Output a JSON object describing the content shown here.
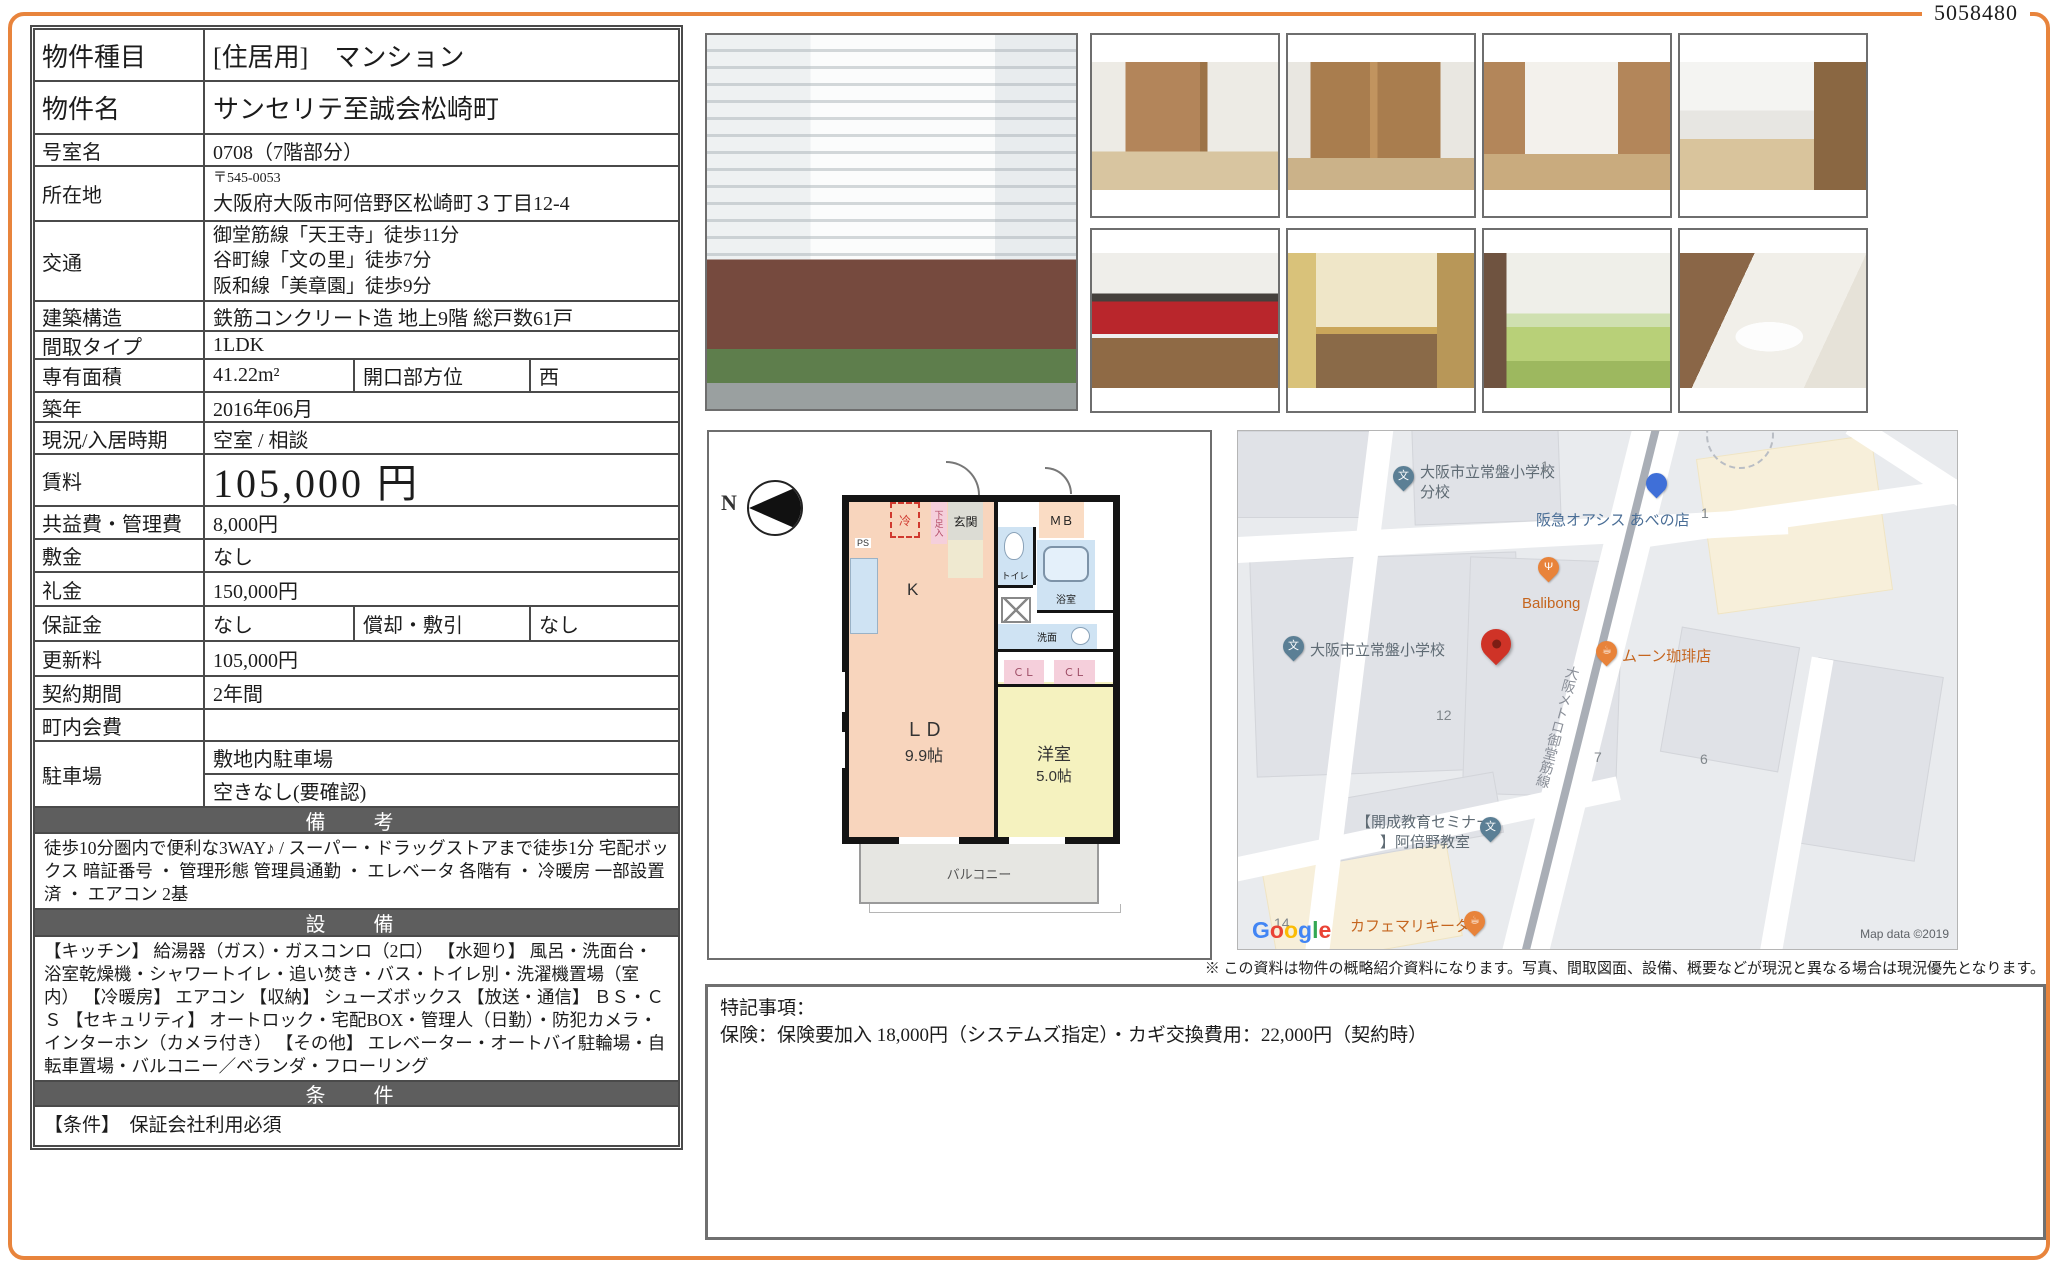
{
  "doc_number": "5058480",
  "colors": {
    "accent_orange": "#e8843c",
    "section_header_gray": "#5e5e5e",
    "marker_red": "#cf3327",
    "plan_ld": "#f8d5bd",
    "plan_west": "#f5f2bf",
    "plan_wet": "#cfe3f3",
    "plan_closet": "#f5cfdb"
  },
  "table": {
    "property_type": {
      "label": "物件種目",
      "value": "[住居用]　マンション"
    },
    "property_name": {
      "label": "物件名",
      "value": "サンセリテ至誠会松崎町"
    },
    "room_no": {
      "label": "号室名",
      "value": "0708（7階部分）"
    },
    "address": {
      "label": "所在地",
      "postal": "〒545-0053",
      "value": "大阪府大阪市阿倍野区松崎町３丁目12-4"
    },
    "transit": {
      "label": "交通",
      "lines": [
        "御堂筋線「天王寺」徒歩11分",
        "谷町線「文の里」徒歩7分",
        "阪和線「美章園」徒歩9分"
      ]
    },
    "structure": {
      "label": "建築構造",
      "value": "鉄筋コンクリート造 地上9階 総戸数61戸"
    },
    "layout_type": {
      "label": "間取タイプ",
      "value": "1LDK"
    },
    "area": {
      "label": "専有面積",
      "value": "41.22m²",
      "sub_label": "開口部方位",
      "sub_value": "西"
    },
    "built": {
      "label": "築年",
      "value": "2016年06月"
    },
    "status": {
      "label": "現況/入居時期",
      "value": "空室 / 相談"
    },
    "rent": {
      "label": "賃料",
      "value": "105,000 円"
    },
    "fees": {
      "label": "共益費・管理費",
      "value": "8,000円"
    },
    "deposit": {
      "label": "敷金",
      "value": "なし"
    },
    "key_money": {
      "label": "礼金",
      "value": "150,000円"
    },
    "guarantee": {
      "label": "保証金",
      "value": "なし",
      "sub_label": "償却・敷引",
      "sub_value": "なし"
    },
    "renewal_fee": {
      "label": "更新料",
      "value": "105,000円"
    },
    "contract_term": {
      "label": "契約期間",
      "value": "2年間"
    },
    "town_fee": {
      "label": "町内会費",
      "value": ""
    },
    "parking": {
      "label": "駐車場",
      "value1": "敷地内駐車場",
      "value2": "空きなし(要確認)"
    },
    "remarks": {
      "header": "備　考",
      "text": "徒歩10分圏内で便利な3WAY♪ /  スーパー・ドラッグストアまで徒歩1分 宅配ボックス 暗証番号 ・ 管理形態 管理員通勤 ・ エレベータ 各階有 ・ 冷暖房 一部設置済 ・ エアコン 2基"
    },
    "equipment": {
      "header": "設　備",
      "text": "【キッチン】 給湯器（ガス）・ガスコンロ（2口） 【水廻り】 風呂・洗面台・浴室乾燥機・シャワートイレ・追い焚き・バス・トイレ別・洗濯機置場（室内） 【冷暖房】 エアコン 【収納】 シューズボックス 【放送・通信】 ＢＳ・ＣＳ 【セキュリティ】 オートロック・宅配BOX・管理人（日勤）・防犯カメラ・インターホン（カメラ付き） 【その他】 エレベーター・オートバイ駐輪場・自転車置場・バルコニー／ベランダ・フローリング"
    },
    "conditions": {
      "header": "条　件",
      "text": "【条件】　保証会社利用必須"
    }
  },
  "floorplan": {
    "compass": "N",
    "labels": {
      "ps": "PS",
      "fridge": "冷",
      "shoe": "下足入",
      "entrance": "玄関",
      "mb": "ＭＢ",
      "toilet": "トイレ",
      "bath": "浴室",
      "wash": "洗面",
      "kitchen": "K",
      "cl1": "ＣＬ",
      "cl2": "ＣＬ",
      "ld_line1": "ＬＤ",
      "ld_line2": "9.9帖",
      "west_line1": "洋室",
      "west_line2": "5.0帖",
      "balcony": "バルコニー"
    }
  },
  "map": {
    "school_branch_l1": "大阪市立常盤小学校",
    "school_branch_l2": "分校",
    "supermarket": "阪急オアシス あべの店",
    "restaurant": "Balibong",
    "school": "大阪市立常盤小学校",
    "cafe1": "ムーン珈琲店",
    "rail": "大阪メトロ御堂筋線",
    "seminar_l1": "【開成教育セミナー",
    "seminar_l2": "】阿倍野教室",
    "cafe2": "カフェマリキータ",
    "block_1a": "1",
    "block_1b": "1",
    "block_12": "12",
    "block_7": "7",
    "block_6": "6",
    "block_14": "14",
    "school_glyph": "文",
    "cafe_glyph": "☕",
    "restaurant_glyph": "Ψ",
    "google_letters": [
      "G",
      "o",
      "o",
      "g",
      "l",
      "e"
    ],
    "map_data": "Map data ©2019"
  },
  "notes": {
    "title": "特記事項：",
    "body": "保険：保険要加入 18,000円（システムズ指定）・カギ交換費用：22,000円（契約時）"
  },
  "disclaimer": "※ この資料は物件の概略紹介資料になります。写真、間取図面、設備、概要などが現況と異なる場合は現況優先となります。"
}
